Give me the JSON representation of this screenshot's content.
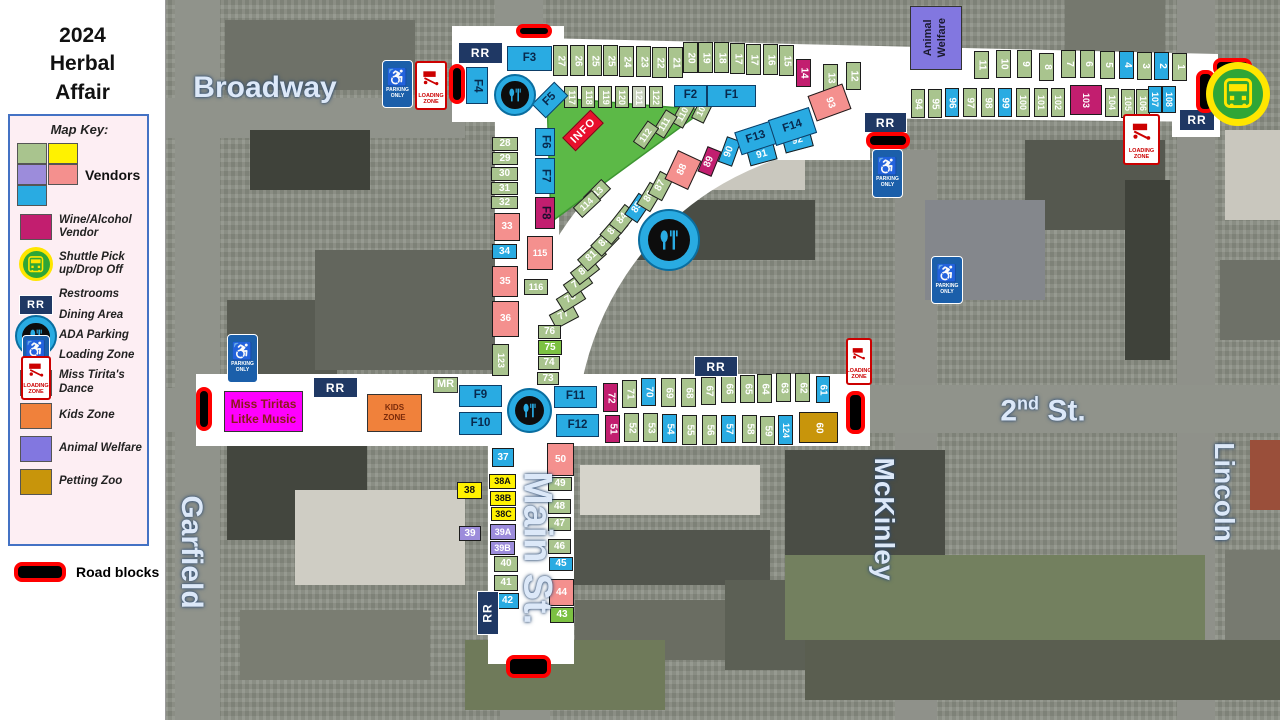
{
  "title_lines": [
    "2024",
    "Herbal",
    "Affair"
  ],
  "colors": {
    "sage": "#a9c48e",
    "bright": "#7cc142",
    "yellow": "#fff200",
    "purple": "#9c8cdb",
    "salmon": "#f4908e",
    "blue": "#29abe2",
    "wine": "#c21e6f",
    "gold": "#c8950b",
    "pale": "#c9d2bd",
    "dance": "#ff00ff",
    "kids": "#f0813b",
    "animal": "#8277e0",
    "rr_navy": "#1f3864",
    "roadblock_red": "#ff0000",
    "park_green": "#5cb947",
    "street_white": "#ffffff",
    "info_red": "#e8112d"
  },
  "legend": {
    "title": "Map Key:",
    "vendors_label": "Vendors",
    "vendor_swatches": [
      "#a9c48e",
      "#fff200",
      "#9c8cdb",
      "#f4908e",
      "#29abe2"
    ],
    "items": [
      {
        "type": "swatch",
        "color": "#c21e6f",
        "label": "Wine/Alcohol Vendor"
      },
      {
        "type": "bus",
        "label": "Shuttle Pick up/Drop Off"
      },
      {
        "type": "rr",
        "label": "Restrooms"
      },
      {
        "type": "dining",
        "label": "Dining Area"
      },
      {
        "type": "ada",
        "label": "ADA Parking"
      },
      {
        "type": "loading",
        "label": "Loading Zone"
      },
      {
        "type": "swatch",
        "color": "#ff00ff",
        "label": "Miss Tirita's Dance"
      },
      {
        "type": "swatch",
        "color": "#f0813b",
        "label": "Kids Zone"
      },
      {
        "type": "swatch",
        "color": "#8277e0",
        "label": "Animal Welfare"
      },
      {
        "type": "swatch",
        "color": "#c8950b",
        "label": "Petting Zoo"
      }
    ],
    "roadblocks_label": "Road blocks"
  },
  "labels": {
    "rr": "RR",
    "info": "INFO",
    "mr": "MR",
    "parking": [
      "PARKING",
      "ONLY"
    ],
    "loading": [
      "LOADING",
      "ZONE"
    ],
    "kids_zone": [
      "KIDS",
      "ZONE"
    ],
    "miss_tiritas": [
      "Miss Tiritas",
      "Litke Music"
    ],
    "animal_welfare": [
      "Animal",
      "Welfare"
    ]
  },
  "street_labels": [
    {
      "text": "Broadway",
      "x": 265,
      "y": 88,
      "size": 30,
      "vertical": false
    },
    {
      "text": "Garfield",
      "x": 191,
      "y": 552,
      "size": 30,
      "vertical": true
    },
    {
      "text": "Main St.",
      "x": 537,
      "y": 548,
      "size": 40,
      "vertical": true
    },
    {
      "text": "2nd St.",
      "base": "2",
      "sup": "nd",
      "rest": " St.",
      "x": 1043,
      "y": 411,
      "size": 30,
      "vertical": false
    },
    {
      "text": "McKinley",
      "x": 884,
      "y": 519,
      "size": 28,
      "vertical": true
    },
    {
      "text": "Lincoln",
      "x": 1224,
      "y": 492,
      "size": 28,
      "vertical": true
    }
  ],
  "booths": [
    [
      "27",
      "sage",
      553,
      45,
      15,
      31,
      0,
      90
    ],
    [
      "26",
      "sage",
      570,
      45,
      15,
      31,
      0,
      90
    ],
    [
      "25",
      "sage",
      587,
      45,
      15,
      31,
      0,
      90
    ],
    [
      "25",
      "sage",
      603,
      45,
      15,
      31,
      0,
      90
    ],
    [
      "24",
      "sage",
      619,
      46,
      15,
      31,
      0,
      90
    ],
    [
      "23",
      "sage",
      636,
      46,
      15,
      31,
      0,
      90
    ],
    [
      "22",
      "sage",
      652,
      47,
      15,
      31,
      0,
      90
    ],
    [
      "21",
      "sage",
      668,
      47,
      15,
      31,
      0,
      90
    ],
    [
      "20",
      "sage",
      683,
      42,
      15,
      31,
      0,
      90
    ],
    [
      "19",
      "sage",
      698,
      42,
      15,
      31,
      0,
      90
    ],
    [
      "18",
      "sage",
      714,
      42,
      15,
      31,
      0,
      90
    ],
    [
      "17",
      "sage",
      730,
      43,
      15,
      31,
      0,
      90
    ],
    [
      "17",
      "sage",
      746,
      44,
      15,
      31,
      0,
      90
    ],
    [
      "16",
      "sage",
      763,
      44,
      15,
      31,
      0,
      90
    ],
    [
      "15",
      "sage",
      779,
      45,
      15,
      31,
      0,
      90
    ],
    [
      "14",
      "wine",
      796,
      59,
      15,
      28,
      0,
      90
    ],
    [
      "13",
      "sage",
      823,
      64,
      15,
      28,
      0,
      90
    ],
    [
      "12",
      "sage",
      846,
      62,
      15,
      28,
      0,
      90
    ],
    [
      "117",
      "sage",
      564,
      86,
      14,
      22,
      0,
      90
    ],
    [
      "118",
      "sage",
      581,
      86,
      14,
      22,
      0,
      90
    ],
    [
      "119",
      "sage",
      598,
      86,
      14,
      22,
      0,
      90
    ],
    [
      "120",
      "sage",
      615,
      86,
      14,
      22,
      0,
      90
    ],
    [
      "121",
      "pale",
      632,
      86,
      14,
      22,
      0,
      90
    ],
    [
      "122",
      "sage",
      649,
      86,
      14,
      22,
      0,
      90
    ],
    [
      "11",
      "sage",
      974,
      51,
      15,
      28,
      0,
      90
    ],
    [
      "10",
      "sage",
      996,
      50,
      15,
      28,
      0,
      90
    ],
    [
      "9",
      "sage",
      1017,
      50,
      15,
      28,
      0,
      90
    ],
    [
      "8",
      "sage",
      1039,
      53,
      15,
      28,
      0,
      90
    ],
    [
      "7",
      "sage",
      1061,
      50,
      15,
      28,
      0,
      90
    ],
    [
      "6",
      "sage",
      1080,
      50,
      15,
      28,
      0,
      90
    ],
    [
      "5",
      "sage",
      1100,
      51,
      15,
      28,
      0,
      90
    ],
    [
      "4",
      "blue",
      1119,
      51,
      15,
      28,
      0,
      90
    ],
    [
      "3",
      "sage",
      1137,
      52,
      15,
      28,
      0,
      90
    ],
    [
      "2",
      "blue",
      1154,
      52,
      15,
      28,
      0,
      90
    ],
    [
      "1",
      "sage",
      1172,
      53,
      15,
      28,
      0,
      90
    ],
    [
      "94",
      "sage",
      911,
      89,
      14,
      29,
      0,
      90
    ],
    [
      "95",
      "sage",
      928,
      89,
      14,
      29,
      0,
      90
    ],
    [
      "96",
      "blue",
      945,
      88,
      14,
      29,
      0,
      90
    ],
    [
      "97",
      "sage",
      963,
      88,
      14,
      29,
      0,
      90
    ],
    [
      "98",
      "sage",
      981,
      88,
      14,
      29,
      0,
      90
    ],
    [
      "99",
      "blue",
      998,
      88,
      14,
      29,
      0,
      90
    ],
    [
      "100",
      "sage",
      1016,
      88,
      14,
      29,
      0,
      90
    ],
    [
      "101",
      "sage",
      1034,
      88,
      14,
      29,
      0,
      90
    ],
    [
      "102",
      "sage",
      1051,
      88,
      14,
      29,
      0,
      90
    ],
    [
      "103",
      "wine",
      1070,
      85,
      32,
      30,
      0,
      90
    ],
    [
      "104",
      "sage",
      1105,
      88,
      14,
      29,
      0,
      90
    ],
    [
      "105",
      "sage",
      1121,
      89,
      14,
      29,
      0,
      90
    ],
    [
      "106",
      "sage",
      1136,
      89,
      14,
      29,
      0,
      90
    ],
    [
      "107",
      "blue",
      1148,
      86,
      14,
      27,
      0,
      90
    ],
    [
      "108",
      "blue",
      1162,
      86,
      14,
      27,
      0,
      90
    ],
    [
      "93",
      "salmon",
      811,
      89,
      37,
      27,
      -20,
      90
    ],
    [
      "77",
      "sage",
      556,
      303,
      16,
      26,
      62,
      -90
    ],
    [
      "78",
      "sage",
      563,
      286,
      16,
      26,
      58,
      -90
    ],
    [
      "79",
      "sage",
      570,
      271,
      16,
      26,
      55,
      -90
    ],
    [
      "80",
      "sage",
      577,
      258,
      16,
      26,
      52,
      -90
    ],
    [
      "81",
      "sage",
      584,
      244,
      16,
      26,
      48,
      -90
    ],
    [
      "82",
      "sage",
      597,
      229,
      16,
      26,
      44,
      -90
    ],
    [
      "83",
      "sage",
      606,
      217,
      16,
      26,
      41,
      -90
    ],
    [
      "84",
      "sage",
      615,
      206,
      16,
      26,
      38,
      -90
    ],
    [
      "85",
      "blue",
      630,
      195,
      16,
      26,
      34,
      -90
    ],
    [
      "86",
      "sage",
      642,
      184,
      16,
      26,
      31,
      -90
    ],
    [
      "87",
      "sage",
      653,
      173,
      16,
      26,
      28,
      -90
    ],
    [
      "88",
      "salmon",
      670,
      154,
      26,
      32,
      25,
      -90
    ],
    [
      "89",
      "wine",
      702,
      148,
      15,
      27,
      22,
      -90
    ],
    [
      "90",
      "blue",
      722,
      138,
      15,
      27,
      20,
      -90
    ],
    [
      "109",
      "sage",
      696,
      96,
      14,
      26,
      26,
      -90
    ],
    [
      "110",
      "sage",
      676,
      101,
      14,
      26,
      29,
      -90
    ],
    [
      "111",
      "sage",
      658,
      111,
      14,
      26,
      32,
      -90
    ],
    [
      "112",
      "sage",
      639,
      122,
      14,
      26,
      35,
      -90
    ],
    [
      "113",
      "sage",
      590,
      180,
      14,
      26,
      45,
      -90
    ],
    [
      "114",
      "sage",
      580,
      191,
      14,
      26,
      47,
      -90
    ],
    [
      "115",
      "salmon",
      527,
      236,
      26,
      34,
      0,
      0
    ],
    [
      "116",
      "sage",
      524,
      279,
      24,
      16,
      0,
      0
    ],
    [
      "28",
      "sage",
      492,
      137,
      26,
      14,
      0,
      0
    ],
    [
      "29",
      "sage",
      492,
      152,
      26,
      13,
      0,
      0
    ],
    [
      "30",
      "sage",
      491,
      167,
      27,
      14,
      0,
      0
    ],
    [
      "31",
      "sage",
      491,
      182,
      27,
      13,
      0,
      0
    ],
    [
      "32",
      "sage",
      491,
      196,
      27,
      13,
      0,
      0
    ],
    [
      "33",
      "salmon",
      494,
      213,
      26,
      28,
      0,
      0
    ],
    [
      "34",
      "blue",
      492,
      244,
      25,
      15,
      0,
      0
    ],
    [
      "35",
      "salmon",
      492,
      266,
      26,
      31,
      0,
      0
    ],
    [
      "36",
      "salmon",
      492,
      301,
      27,
      36,
      0,
      0
    ],
    [
      "123",
      "sage",
      492,
      344,
      17,
      32,
      0,
      90
    ],
    [
      "76",
      "sage",
      538,
      325,
      23,
      14,
      0,
      0
    ],
    [
      "75",
      "bright",
      538,
      340,
      24,
      15,
      0,
      0
    ],
    [
      "74",
      "sage",
      538,
      356,
      22,
      14,
      0,
      0
    ],
    [
      "73",
      "sage",
      537,
      372,
      22,
      13,
      0,
      0
    ],
    [
      "72",
      "wine",
      603,
      383,
      15,
      29,
      0,
      90
    ],
    [
      "71",
      "sage",
      622,
      380,
      15,
      28,
      0,
      90
    ],
    [
      "70",
      "blue",
      641,
      378,
      15,
      28,
      0,
      90
    ],
    [
      "69",
      "sage",
      661,
      378,
      15,
      29,
      0,
      90
    ],
    [
      "68",
      "sage",
      681,
      378,
      15,
      29,
      0,
      90
    ],
    [
      "67",
      "sage",
      701,
      377,
      15,
      28,
      0,
      90
    ],
    [
      "66",
      "sage",
      721,
      375,
      15,
      28,
      0,
      90
    ],
    [
      "65",
      "sage",
      740,
      375,
      15,
      28,
      0,
      90
    ],
    [
      "64",
      "sage",
      757,
      374,
      15,
      29,
      0,
      90
    ],
    [
      "63",
      "sage",
      776,
      373,
      15,
      29,
      0,
      90
    ],
    [
      "62",
      "sage",
      795,
      373,
      15,
      29,
      0,
      90
    ],
    [
      "61",
      "blue",
      816,
      376,
      14,
      27,
      0,
      90
    ],
    [
      "51",
      "wine",
      605,
      415,
      15,
      28,
      0,
      90
    ],
    [
      "52",
      "sage",
      624,
      413,
      15,
      29,
      0,
      90
    ],
    [
      "53",
      "sage",
      643,
      413,
      15,
      29,
      0,
      90
    ],
    [
      "54",
      "blue",
      662,
      414,
      15,
      29,
      0,
      90
    ],
    [
      "55",
      "sage",
      682,
      415,
      15,
      30,
      0,
      90
    ],
    [
      "56",
      "sage",
      702,
      415,
      15,
      30,
      0,
      90
    ],
    [
      "57",
      "blue",
      721,
      415,
      15,
      28,
      0,
      90
    ],
    [
      "58",
      "sage",
      742,
      415,
      15,
      28,
      0,
      90
    ],
    [
      "59",
      "sage",
      760,
      416,
      15,
      29,
      0,
      90
    ],
    [
      "124",
      "blue",
      778,
      415,
      15,
      30,
      0,
      90
    ],
    [
      "60",
      "gold",
      799,
      412,
      39,
      31,
      0,
      90
    ],
    [
      "37",
      "blue",
      492,
      448,
      22,
      19,
      0,
      0
    ],
    [
      "38",
      "yellow",
      457,
      482,
      25,
      17,
      0,
      0
    ],
    [
      "38A",
      "yellow",
      489,
      474,
      27,
      15,
      0,
      0
    ],
    [
      "38B",
      "yellow",
      490,
      491,
      26,
      15,
      0,
      0
    ],
    [
      "38C",
      "yellow",
      491,
      507,
      25,
      14,
      0,
      0
    ],
    [
      "39",
      "purple",
      459,
      526,
      22,
      15,
      0,
      0
    ],
    [
      "39A",
      "purple",
      490,
      524,
      26,
      16,
      0,
      0
    ],
    [
      "39B",
      "purple",
      490,
      541,
      25,
      14,
      0,
      0
    ],
    [
      "40",
      "sage",
      494,
      556,
      24,
      16,
      0,
      0
    ],
    [
      "41",
      "sage",
      494,
      575,
      24,
      16,
      0,
      0
    ],
    [
      "42",
      "blue",
      496,
      593,
      23,
      16,
      0,
      0
    ],
    [
      "50",
      "salmon",
      547,
      443,
      27,
      33,
      0,
      0
    ],
    [
      "49",
      "sage",
      548,
      477,
      24,
      14,
      0,
      0
    ],
    [
      "48",
      "sage",
      548,
      499,
      23,
      15,
      0,
      0
    ],
    [
      "47",
      "sage",
      548,
      517,
      23,
      14,
      0,
      0
    ],
    [
      "46",
      "sage",
      548,
      539,
      23,
      15,
      0,
      0
    ],
    [
      "45",
      "blue",
      549,
      557,
      24,
      14,
      0,
      0
    ],
    [
      "44",
      "salmon",
      549,
      579,
      25,
      27,
      0,
      0
    ],
    [
      "43",
      "bright",
      550,
      607,
      24,
      16,
      0,
      0
    ],
    [
      "91",
      "blue",
      748,
      147,
      28,
      16,
      -15,
      0
    ],
    [
      "92",
      "blue",
      783,
      132,
      29,
      18,
      -15,
      0
    ]
  ],
  "fbooths": [
    [
      "F1",
      707,
      85,
      49,
      22,
      0,
      0
    ],
    [
      "F2",
      674,
      85,
      33,
      22,
      0,
      0
    ],
    [
      "F3",
      507,
      46,
      45,
      25,
      0,
      0
    ],
    [
      "F4",
      466,
      67,
      22,
      37,
      0,
      90
    ],
    [
      "F5",
      540,
      84,
      20,
      32,
      45,
      -90
    ],
    [
      "F6",
      535,
      128,
      20,
      28,
      0,
      90
    ],
    [
      "F7",
      535,
      158,
      20,
      36,
      0,
      90
    ],
    [
      "F9",
      459,
      385,
      43,
      22,
      0,
      0
    ],
    [
      "F10",
      459,
      412,
      43,
      23,
      0,
      0
    ],
    [
      "F11",
      554,
      386,
      43,
      22,
      0,
      0
    ],
    [
      "F12",
      556,
      414,
      43,
      23,
      0,
      0
    ],
    [
      "F13",
      737,
      126,
      38,
      24,
      -18,
      0
    ],
    [
      "F14",
      771,
      113,
      43,
      27,
      -18,
      0
    ]
  ],
  "f8": [
    "F8",
    535,
    197,
    20,
    32,
    0,
    90
  ],
  "rr_boxes": [
    [
      458,
      42,
      45,
      22,
      0
    ],
    [
      313,
      377,
      45,
      21,
      0
    ],
    [
      694,
      356,
      44,
      21,
      0
    ],
    [
      864,
      112,
      43,
      21,
      0
    ],
    [
      1179,
      109,
      36,
      22,
      0
    ],
    [
      477,
      591,
      22,
      44,
      -90
    ]
  ],
  "roadblocks": [
    [
      516,
      24,
      36,
      14
    ],
    [
      449,
      64,
      16,
      40
    ],
    [
      1213,
      58,
      39,
      18
    ],
    [
      1196,
      70,
      19,
      43
    ],
    [
      866,
      132,
      44,
      17
    ],
    [
      846,
      391,
      19,
      43
    ],
    [
      196,
      387,
      16,
      44
    ],
    [
      506,
      655,
      45,
      23
    ]
  ],
  "ada_signs": [
    [
      382,
      60,
      31,
      48
    ],
    [
      227,
      334,
      31,
      49
    ],
    [
      872,
      149,
      31,
      49
    ],
    [
      931,
      256,
      32,
      48
    ]
  ],
  "loading_signs": [
    [
      415,
      61,
      32,
      49
    ],
    [
      846,
      338,
      26,
      47
    ],
    [
      1123,
      114,
      37,
      51
    ]
  ],
  "dining_areas": [
    [
      494,
      74,
      38
    ],
    [
      638,
      209,
      58
    ],
    [
      507,
      388,
      41
    ]
  ],
  "shuttle": [
    1206,
    62,
    64
  ],
  "info_sign": {
    "x": 563,
    "y": 121,
    "w": 38,
    "h": 17,
    "r": -45
  },
  "zones": {
    "animal_welfare": {
      "x": 910,
      "y": 6,
      "w": 52,
      "h": 64
    },
    "miss_tiritas": {
      "x": 224,
      "y": 391,
      "w": 79,
      "h": 41
    },
    "kids_zone": {
      "x": 367,
      "y": 394,
      "w": 55,
      "h": 38
    },
    "mr": {
      "x": 433,
      "y": 377,
      "w": 25,
      "h": 16
    }
  },
  "park_triangle": "547,97 704,110 551,222"
}
